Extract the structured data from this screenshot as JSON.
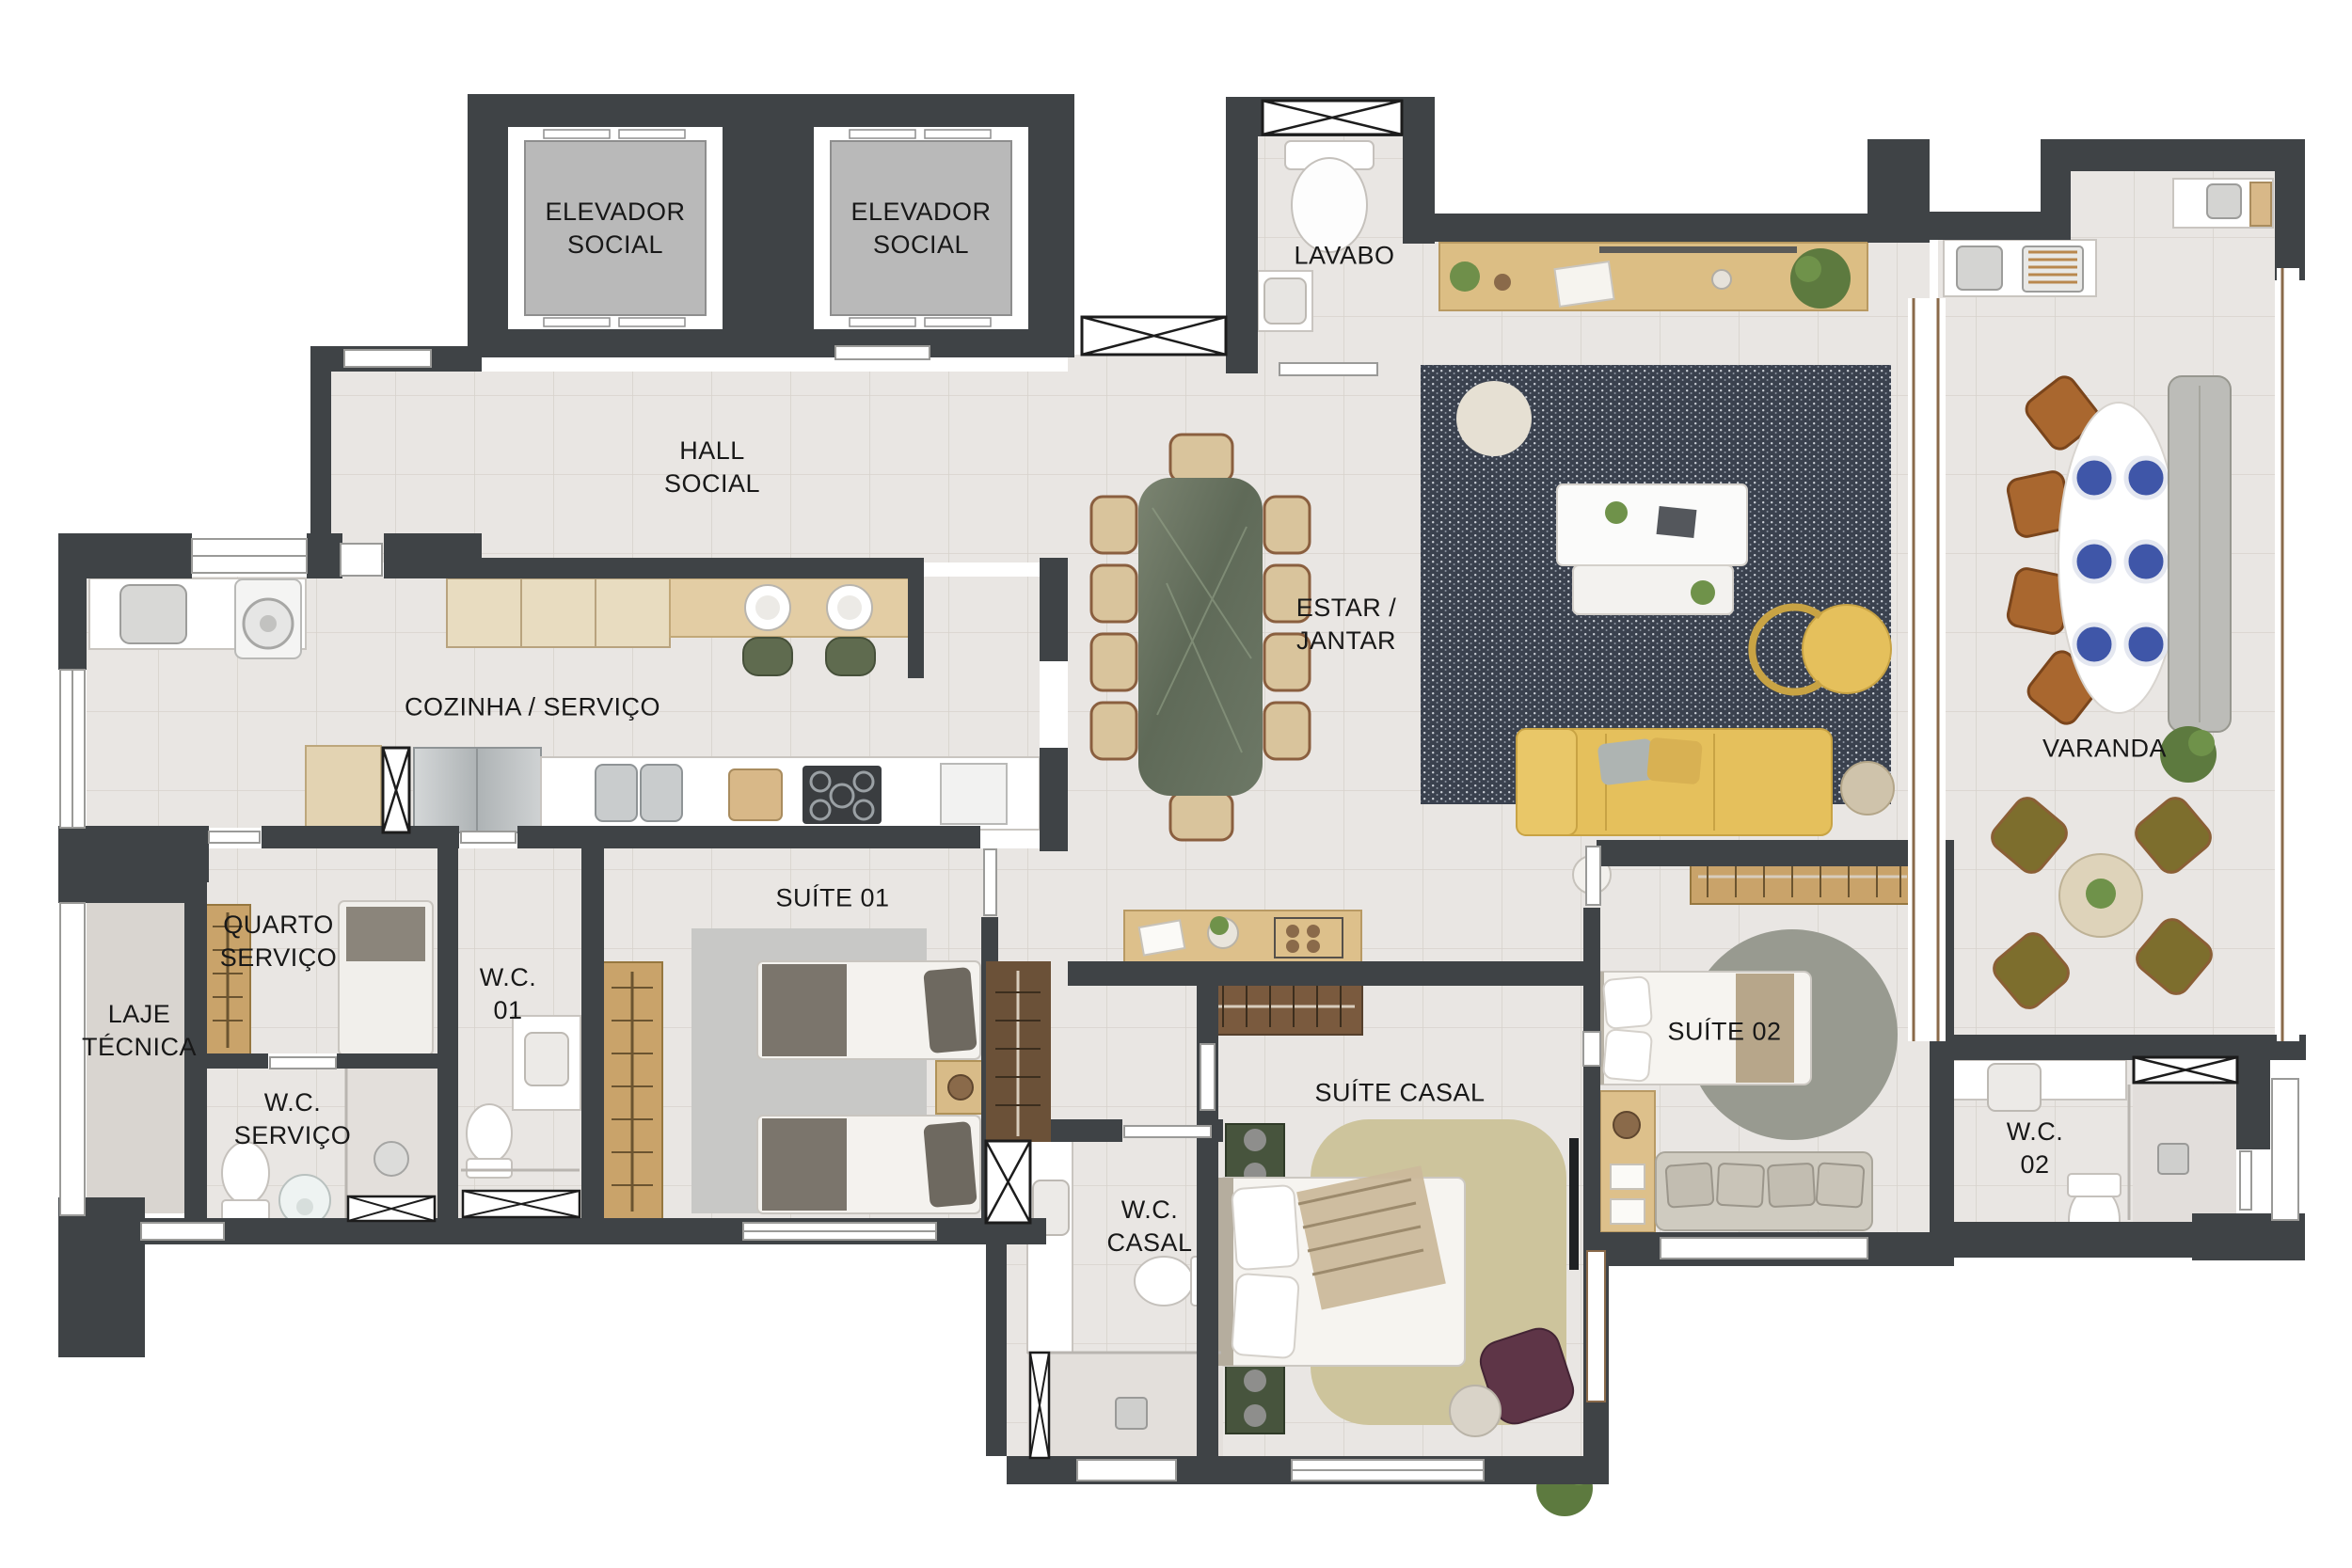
{
  "plan_title": "Apartment floor plan",
  "rooms": {
    "elevator1": "ELEVADOR\nSOCIAL",
    "elevator2": "ELEVADOR\nSOCIAL",
    "lavabo": "LAVABO",
    "hall": "HALL\nSOCIAL",
    "cozinha": "COZINHA / SERVIÇO",
    "estar": "ESTAR /\nJANTAR",
    "varanda": "VARANDA",
    "laje": "LAJE\nTÉCNICA",
    "quarto_servico": "QUARTO\nSERVIÇO",
    "wc_servico": "W.C.\nSERVIÇO",
    "wc01": "W.C.\n01",
    "suite01": "SUÍTE 01",
    "suite_casal": "SUÍTE CASAL",
    "wc_casal": "W.C.\nCASAL",
    "suite02": "SUÍTE 02",
    "wc02": "W.C.\n02"
  },
  "palette": {
    "wall": "#3f4346",
    "floor": "#e9e6e3",
    "wood": "#d9bb85",
    "sofa_yellow": "#e5c05c",
    "rug_dark": "#3a414e",
    "marble_green": "#6d7866",
    "plate_blue": "#3f56a8",
    "chair_olive": "#7d6e2d",
    "chair_brown": "#a9672f"
  }
}
